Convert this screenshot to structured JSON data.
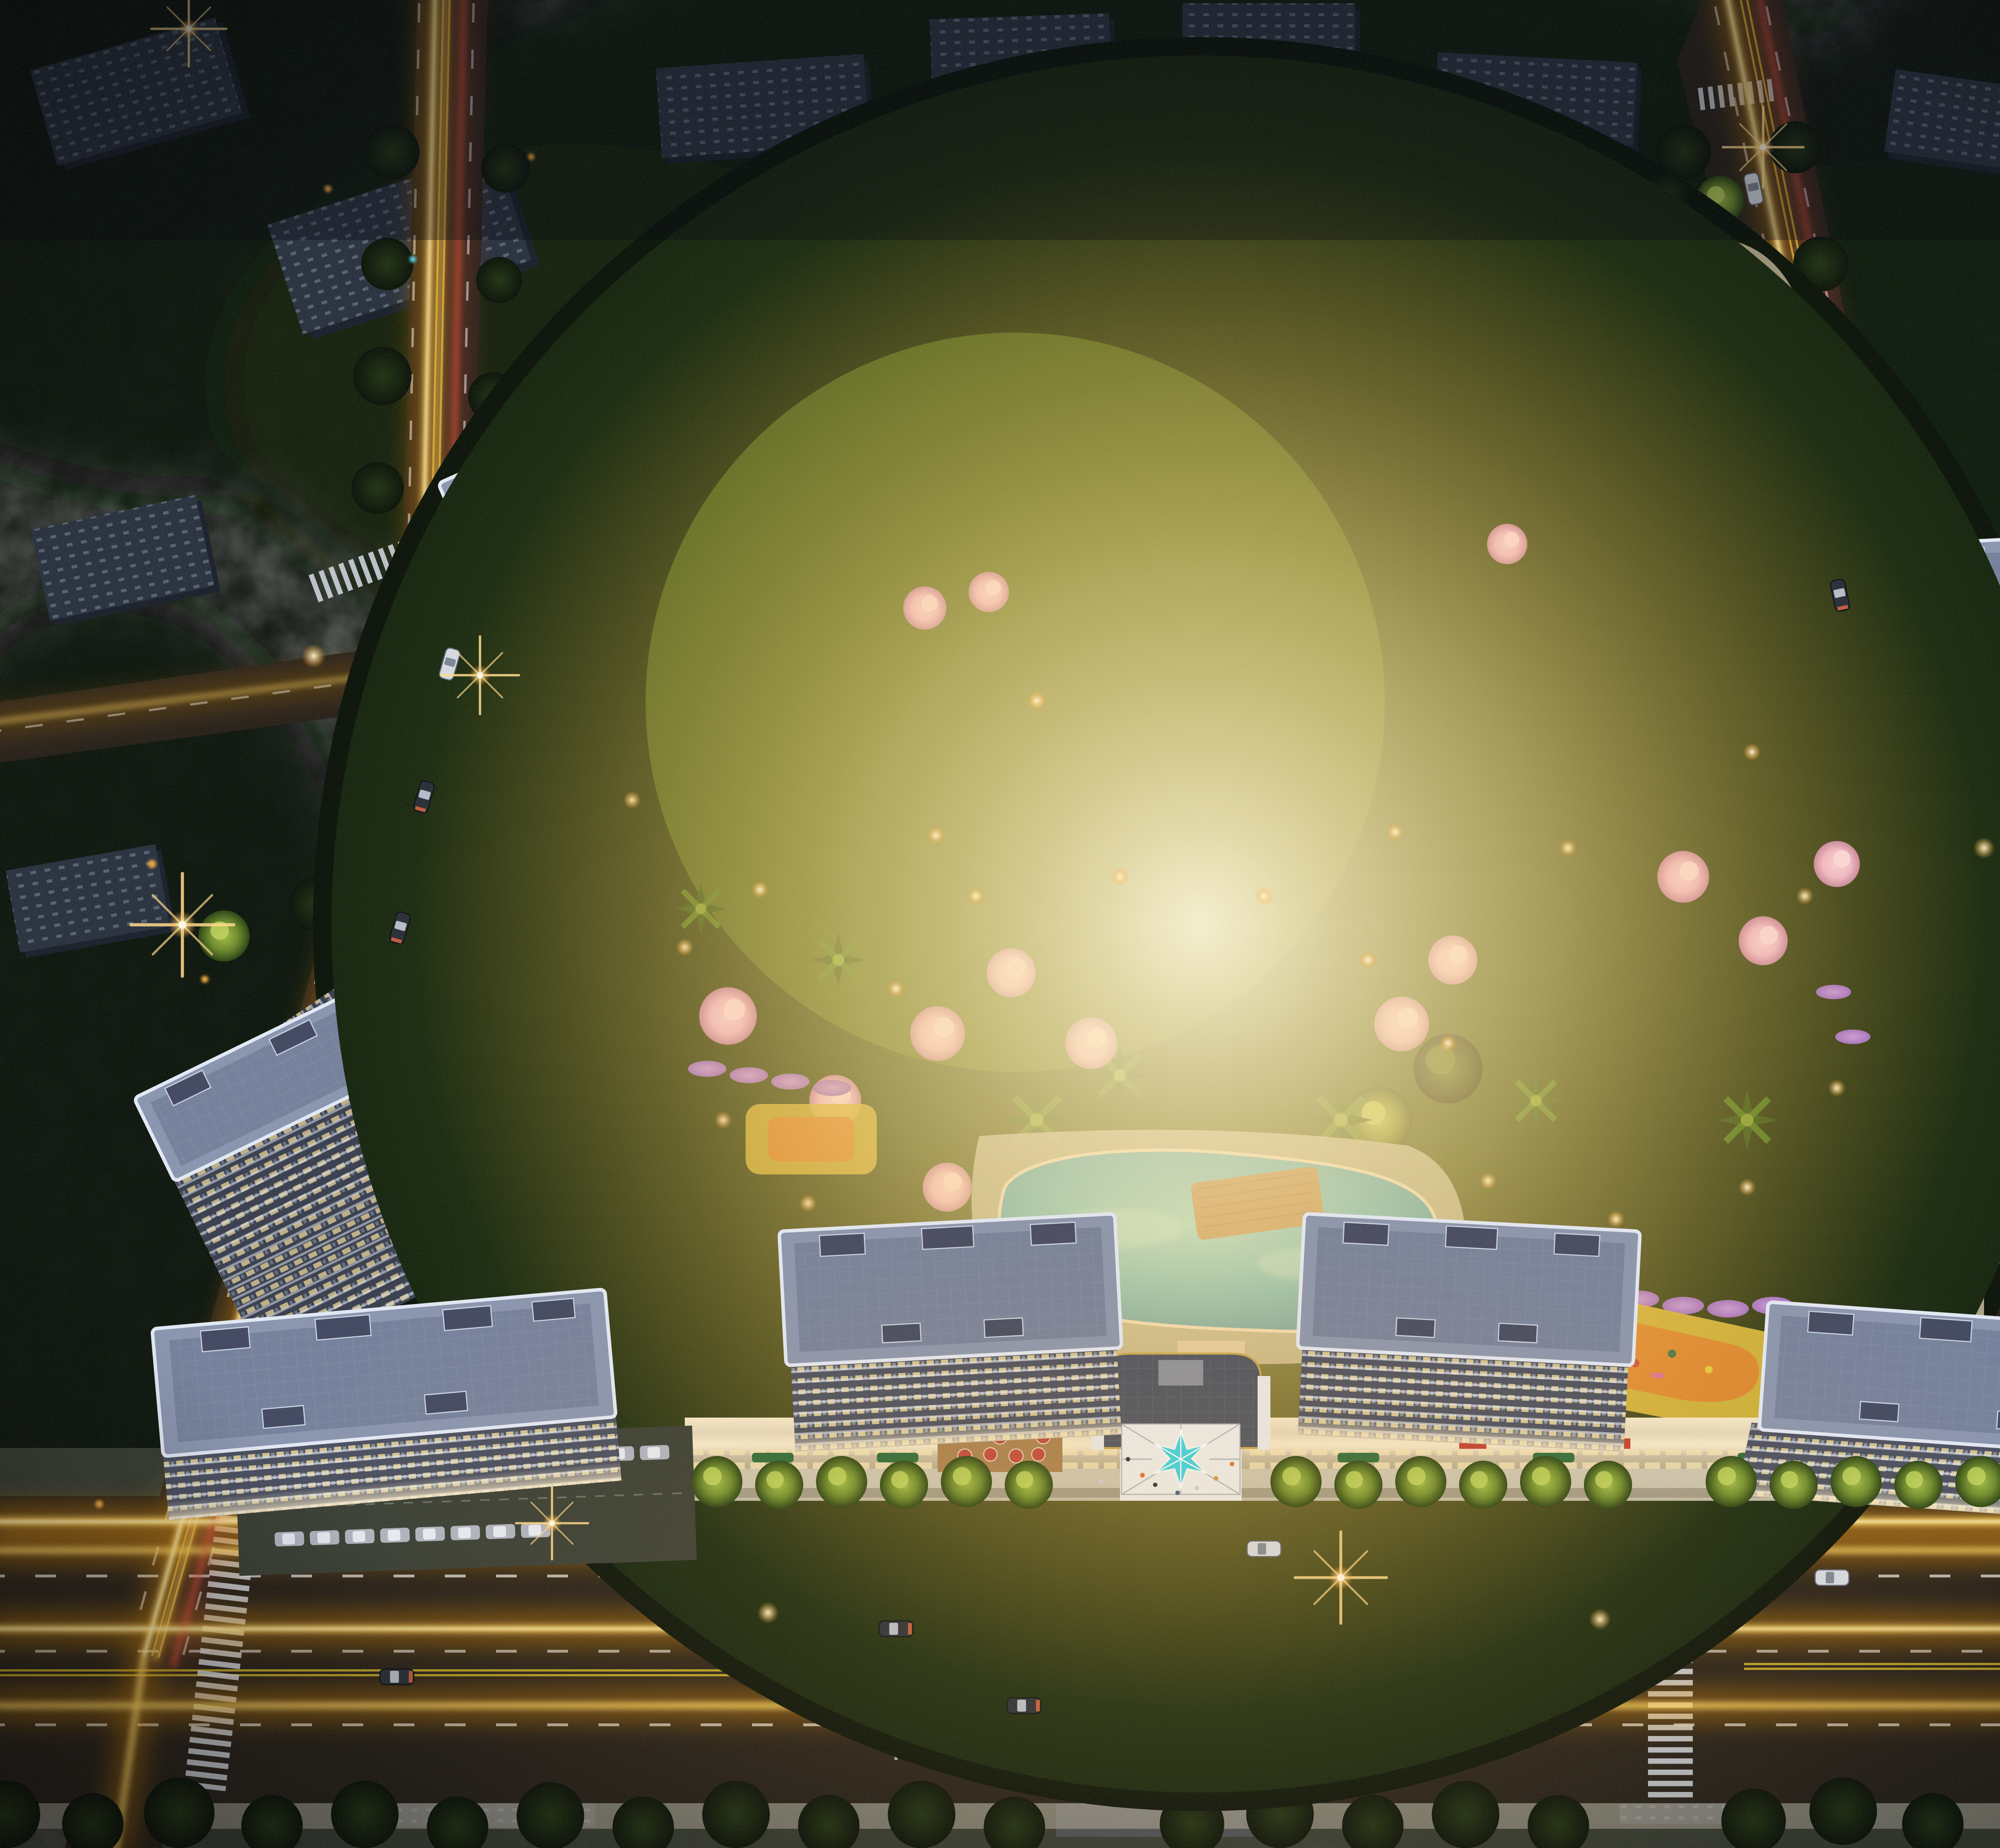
{
  "scene": {
    "type": "aerial-architectural-render",
    "time_of_day": "dusk",
    "subject": "Night-time aerial rendering of a high-rise residential complex with illuminated towers, a landscaped courtyard with swimming pool, a star-shaped entrance canopy, retail podium and glowing city streets",
    "features": [
      "residential-towers",
      "retail-podium",
      "entrance-star-canopy",
      "swimming-pool",
      "courtyard-gardens",
      "cherry-blossom-trees",
      "palm-trees",
      "playground",
      "rooftop-garden",
      "tree-lined-streets",
      "traffic-light-trails",
      "street-lamps",
      "crosswalks",
      "surface-parking",
      "surrounding-low-rise-blocks"
    ]
  },
  "palette": {
    "background": "#0c120c",
    "tree_dark": "#16220f",
    "tree_lit": "#6f8c2c",
    "blossom_pink": "#efbcdc",
    "flower_purple": "#9d6fd0",
    "road": "#27211a",
    "sidewalk": "#b9b2a4",
    "plaza_white": "#eceded",
    "lane_white": "#d8dde6",
    "lane_yellow": "#d2b92c",
    "trail_glow": "#e8920f",
    "trail_core": "#ffd761",
    "trail_hot": "#fff3c4",
    "trail_red": "#e05038",
    "roof": "#8a95af",
    "roof_inner": "#727e9a",
    "roof_tall": "#99a4be",
    "parapet": "#e3e9f5",
    "roof_unit": "#424961",
    "facade": "#3a3f4f",
    "facade_front": "#4a4f60",
    "facade_tall": "#2e3342",
    "window_warm": "#f0dc9e",
    "window_cool": "#9fb7cc",
    "glass_lit": "#dcc890",
    "podium_glow": "#f6e9cb",
    "signage_red": "#c23f32",
    "umbrella_red": "#c04838",
    "context_building": "#2a323f",
    "context_window": "#9db0c4",
    "lawn": "#42521c",
    "lawn_lit": "#8da338",
    "paving_lit": "#d3c8a6",
    "path": "#e2d8b4",
    "pool_light": "#7fe0f2",
    "pool_deep": "#1f84b2",
    "deck_wood": "#a97f4e",
    "play_orange": "#d9852e",
    "play_yellow": "#d3b93c",
    "canopy_cyan": "#3ad2e4",
    "gate_gray": "#4b5160",
    "flare": "#ffd98a",
    "car_dark": "#2a2f38",
    "car_white": "#d6dae2"
  }
}
